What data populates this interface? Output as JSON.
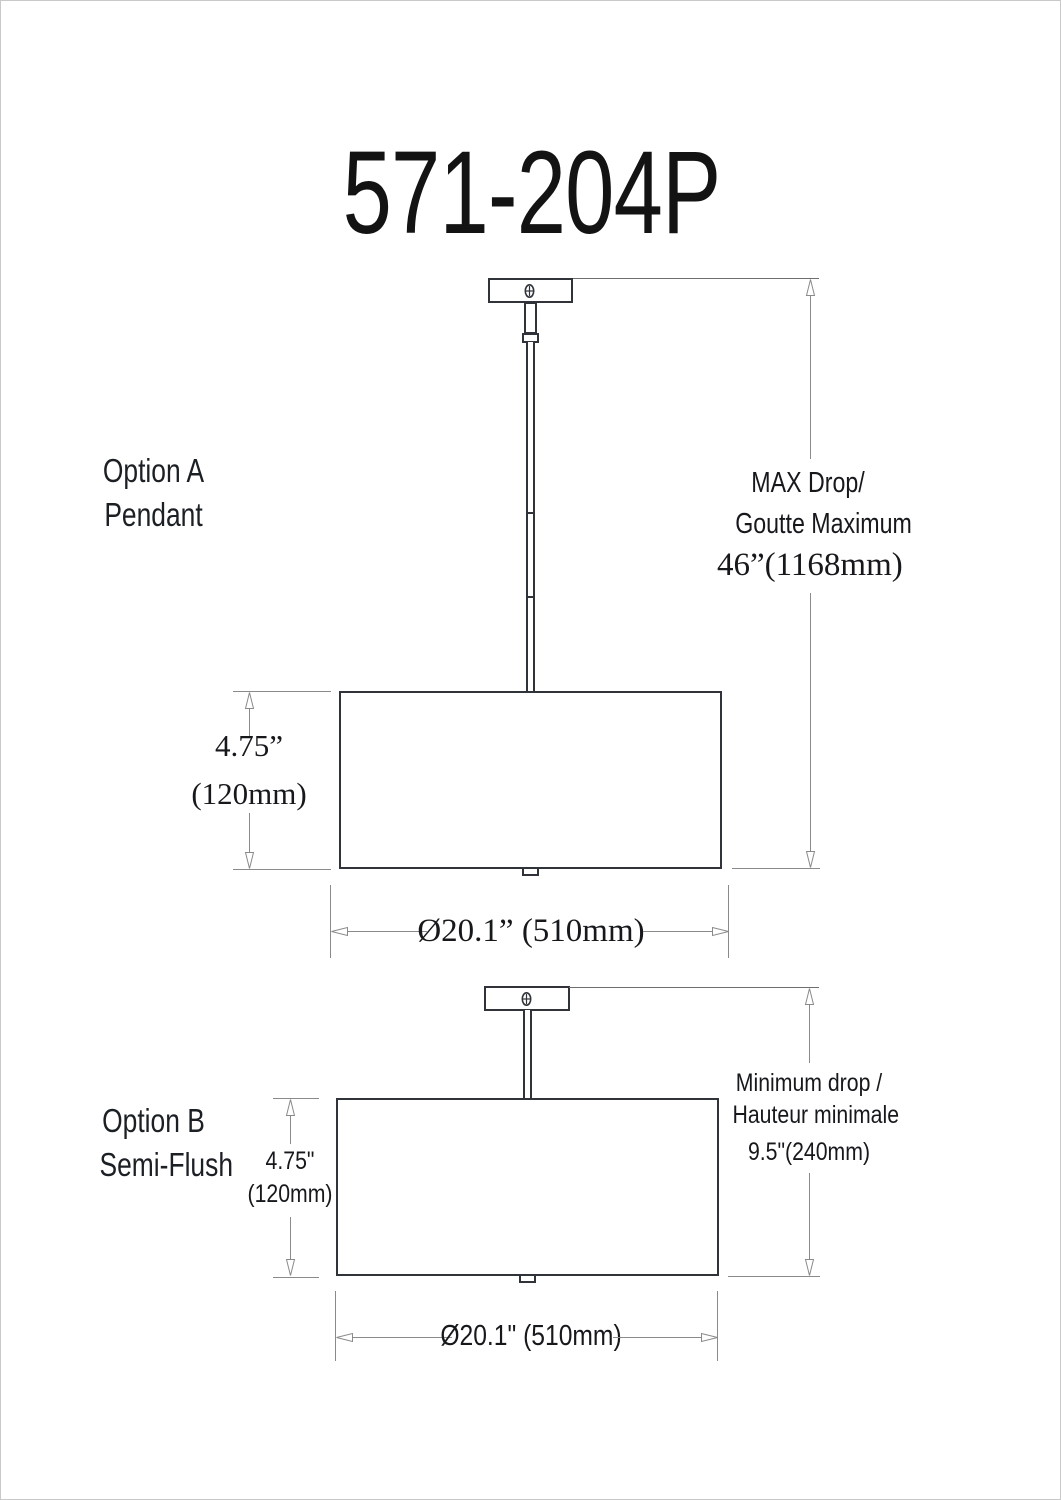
{
  "title": "571-204P",
  "colors": {
    "fixture_line": "#30343a",
    "dimension_line": "#8a8a8a",
    "text": "#16181c",
    "background": "#ffffff"
  },
  "option_a": {
    "label": [
      "Option A",
      "Pendant"
    ],
    "height_dim": [
      "4.75”",
      "(120mm)"
    ],
    "diameter_dim": "Ø20.1” (510mm)",
    "drop_dim": [
      "MAX Drop/",
      "Goutte Maximum",
      "46”(1168mm)"
    ]
  },
  "option_b": {
    "label": [
      "Option B",
      "Semi-Flush"
    ],
    "height_dim": [
      "4.75\"",
      "(120mm)"
    ],
    "diameter_dim": "Ø20.1\" (510mm)",
    "drop_dim": [
      "Minimum drop /",
      "Hauteur minimale",
      "9.5\"(240mm)"
    ]
  }
}
